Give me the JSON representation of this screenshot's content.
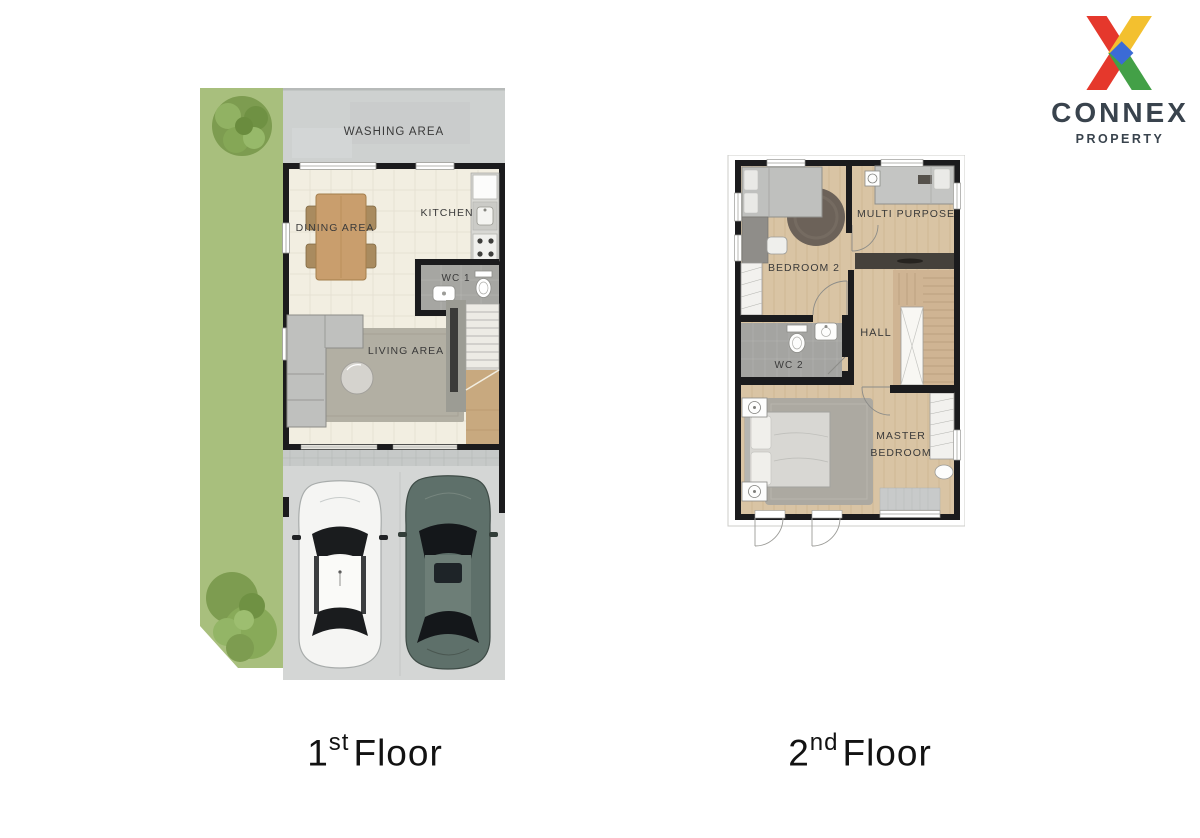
{
  "logo": {
    "brand": "CONNEX",
    "tagline": "PROPERTY",
    "icon": "connex-x-logo",
    "colors": {
      "red": "#E5382C",
      "yellow": "#F3C02F",
      "green": "#43A047",
      "blue": "#3B6BD6",
      "text": "#39434D"
    }
  },
  "first_floor": {
    "caption": {
      "number": "1",
      "ordinal": "st",
      "word": "Floor"
    },
    "labels": {
      "washing_area": "WASHING AREA",
      "dining_area": "DINING AREA",
      "kitchen": "KITCHEN",
      "wc": "WC 1",
      "living_area": "LIVING AREA"
    }
  },
  "second_floor": {
    "caption": {
      "number": "2",
      "ordinal": "nd",
      "word": "Floor"
    },
    "labels": {
      "bedroom2": "BEDROOM 2",
      "multi_purpose": "MULTI PURPOSE",
      "hall": "HALL",
      "wc": "WC 2",
      "master_line1": "MASTER",
      "master_line2": "BEDROOM"
    }
  },
  "palette": {
    "grass": "#A8BF7D",
    "concrete": "#D3D5D4",
    "floor_cream": "#F2EEE1",
    "wood_floor": "#D9C4A4",
    "wall": "#1B1B1D",
    "label_text": "#3A3A3A",
    "car_white": "#F5F5F3",
    "car_green": "#5E706A"
  }
}
